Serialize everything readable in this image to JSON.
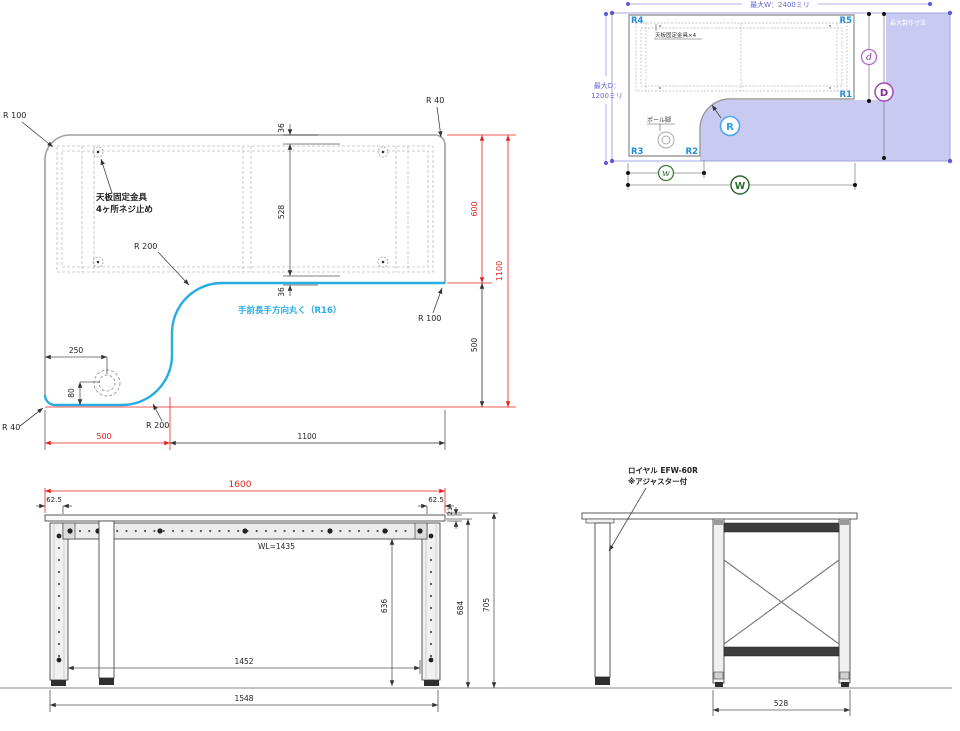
{
  "plan": {
    "r100_top_left": "R 100",
    "r40_top_right": "R 40",
    "fixture_note_line1": "天板固定金具",
    "fixture_note_line2": "4ヶ所ネジ止め",
    "r200_mid": "R 200",
    "front_round_note": "手前長手方向丸く（R16）",
    "r100_right": "R 100",
    "dim_36_top": "36",
    "dim_528": "528",
    "dim_36_bottom": "36",
    "dim_600": "600",
    "dim_1100_right": "1100",
    "dim_500_right": "500",
    "dim_250": "250",
    "dim_80": "80",
    "r40_bottom_left": "R 40",
    "r200_bottom": "R 200",
    "dim_500_bottom": "500",
    "dim_1100_bottom": "1100"
  },
  "schematic": {
    "max_w": "最大W：2400ミリ",
    "max_d_line1": "最大D：",
    "max_d_line2": "1200ミリ",
    "max_make_note": "最大製作寸法",
    "fixture_note": "天板固定金具×4",
    "pole_leg": "ポール脚",
    "r1": "R1",
    "r2": "R2",
    "r3": "R3",
    "r4": "R4",
    "r5": "R5",
    "badge_r": "R",
    "badge_d_small": "d",
    "badge_d_big": "D",
    "badge_w_small": "w",
    "badge_w_big": "W"
  },
  "front": {
    "dim_1600": "1600",
    "dim_62_5_left": "62.5",
    "dim_62_5_right": "62.5",
    "dim_21": "21",
    "wl_label": "WL=1435",
    "dim_636": "636",
    "dim_684": "684",
    "dim_705": "705",
    "dim_1452": "1452",
    "dim_1548": "1548"
  },
  "side": {
    "part_label_line1": "ロイヤル EFW-60R",
    "part_label_line2": "※アジャスター付",
    "dim_528": "528"
  },
  "colors": {
    "accent_red": "#e5231b",
    "accent_blue": "#29abe2",
    "label_blue": "#1e8fdd",
    "lavender_fill": "#c9caf1",
    "purple_line": "#9d9de2",
    "green": "#2d6a2d",
    "violet": "#8a2b9e"
  }
}
